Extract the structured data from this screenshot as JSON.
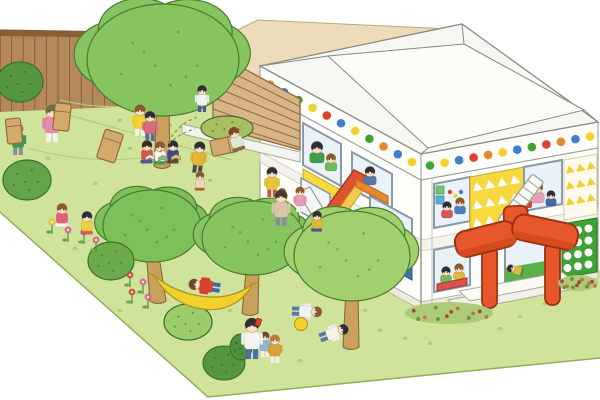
{
  "scene": {
    "subject": "Children playing in a kindergarten playground illustration",
    "elements": [
      "wooden plank fence",
      "grass yard",
      "two-story nursery building with polka-dot roof trim",
      "orange entrance canopy",
      "trees",
      "hammock",
      "sack race",
      "flower patches"
    ]
  },
  "colors": {
    "sky": "#ffffff",
    "grass": "#cfe39a",
    "grassEdge": "#93ad5c",
    "grassTuft": "#a4bf6a",
    "contour": "#b2cc7a",
    "fence": "#b5885c",
    "fenceLine": "#86603a",
    "fenceCap": "#8a5f38",
    "beige": "#ecdcba",
    "beigeLine": "#bba878",
    "louver": "#d9b487",
    "louverLine": "#8a6a42",
    "wall": "#fdfdf9",
    "wallLine": "#97978c",
    "roof": "#f6f6f2",
    "roofTop": "#fcfcf9",
    "plinth": "#ecebdd",
    "band": "#f3f3ec",
    "treeGreen": "#85c45e",
    "treeDark": "#4a7c30",
    "treeLight": "#a2d06e",
    "trunk": "#c9a05e",
    "trunkLine": "#8a6a3a",
    "orange": "#e8572b",
    "orangeDark": "#9c3312",
    "orangeShade": "#d64a20",
    "yellowPanel": "#f7d83e",
    "yellowDeep": "#f2cf2e",
    "yellowLine": "#c9a82a",
    "bluePanel": "#3f6fb5",
    "windowGlass": "#e8f2f8",
    "frame": "#8a9aa8",
    "greenWall": "#3fa235",
    "skin": "#f7dfc2",
    "skinLine": "#caa27b",
    "sack": "#d3a96c",
    "sackLine": "#8a6a3a",
    "hammock": "#f2d12e",
    "hammockLine": "#b09418",
    "ball": "#f2d12e",
    "ballLine": "#b89a1f",
    "bedBase": "#aac973",
    "bedDot1": "#9a4f3f",
    "bedDot2": "#c96a55",
    "bedDot3": "#6a8f3f",
    "deskOrange": "#e8872b",
    "tableRed": "#d9534f",
    "toyOrange": "#e8a13a",
    "eye": "#4a3a30"
  },
  "fence": {
    "planks": 19
  },
  "louver": {
    "slats": 6
  },
  "building": {
    "floors": 2,
    "fascia_dots_left": [
      "#e8872b",
      "#3f7fd1",
      "#3fa235",
      "#f2d12e",
      "#d9442e",
      "#3f7fd1",
      "#f2d12e",
      "#3fa235",
      "#e8872b",
      "#3f7fd1",
      "#f2d12e"
    ],
    "fascia_dots_right": [
      "#3fa235",
      "#f2d12e",
      "#3f7fd1",
      "#d9442e",
      "#e8872b",
      "#f2d12e",
      "#3f7fd1",
      "#3fa235",
      "#d9442e",
      "#e8872b",
      "#3f7fd1",
      "#f2d12e"
    ],
    "window_dots": [
      "#d9442e",
      "#f2d12e",
      "#3f7fd1"
    ],
    "panel_squares": [
      "#6fc96f",
      "#5ab0d0"
    ]
  },
  "trees": [
    {
      "name": "big-tree",
      "cx": 163,
      "cy": 60,
      "rx": 76,
      "ry": 56,
      "baseX": 162,
      "baseY": 166,
      "fill": "#85c45e"
    },
    {
      "name": "hammock-tree-left",
      "cx": 152,
      "cy": 226,
      "rx": 49,
      "ry": 36,
      "baseX": 158,
      "baseY": 301,
      "fill": "#7dbf58"
    },
    {
      "name": "hammock-tree-right",
      "cx": 253,
      "cy": 238,
      "rx": 51,
      "ry": 37,
      "baseX": 250,
      "baseY": 313,
      "fill": "#85c45e"
    },
    {
      "name": "front-tree",
      "cx": 352,
      "cy": 256,
      "rx": 58,
      "ry": 45,
      "baseX": 351,
      "baseY": 347,
      "fill": "#a2d06e"
    }
  ],
  "bushes": [
    {
      "cx": 20,
      "cy": 82,
      "rx": 23,
      "ry": 20,
      "fill": "#55973f"
    },
    {
      "cx": 227,
      "cy": 128,
      "rx": 26,
      "ry": 12,
      "fill": "#a8bf63"
    },
    {
      "cx": 27,
      "cy": 180,
      "rx": 24,
      "ry": 20,
      "fill": "#63a449"
    },
    {
      "cx": 111,
      "cy": 261,
      "rx": 23,
      "ry": 19,
      "fill": "#6cab4c"
    },
    {
      "cx": 188,
      "cy": 322,
      "rx": 24,
      "ry": 18,
      "fill": "#9ccb6a"
    },
    {
      "cx": 224,
      "cy": 363,
      "rx": 21,
      "ry": 17,
      "fill": "#55973f"
    },
    {
      "cx": 241,
      "cy": 347,
      "rx": 11,
      "ry": 13,
      "fill": "#4e8f3d"
    }
  ],
  "flower_clusters": [
    {
      "cx": 72,
      "cy": 232,
      "flowers": [
        {
          "dx": -20,
          "dy": -10,
          "c": "#f2d12e"
        },
        {
          "dx": -4,
          "dy": -2,
          "c": "#e86aa0"
        },
        {
          "dx": 12,
          "dy": 0,
          "c": "#9a5ab8"
        },
        {
          "dx": 24,
          "dy": 8,
          "c": "#e86aa0"
        }
      ]
    },
    {
      "cx": 138,
      "cy": 287,
      "flowers": [
        {
          "dx": -8,
          "dy": -12,
          "c": "#d9534f"
        },
        {
          "dx": 5,
          "dy": -5,
          "c": "#e86aa0"
        },
        {
          "dx": -6,
          "dy": 5,
          "c": "#d9534f"
        },
        {
          "dx": 10,
          "dy": 10,
          "c": "#e86aa0"
        }
      ]
    }
  ],
  "flower_beds": [
    {
      "cx": 449,
      "cy": 313,
      "rx": 44,
      "ry": 11
    },
    {
      "cx": 578,
      "cy": 283,
      "rx": 20,
      "ry": 8
    }
  ],
  "figures": [
    {
      "name": "standing-kid-top",
      "x": 202,
      "y": 112,
      "s": 0.85,
      "pose": "stand",
      "rot": 0,
      "hair": "#2e2e38",
      "shirt": "#eef2f5",
      "pants": "#4a5a8e",
      "layer": "yard"
    },
    {
      "name": "sack-kid-green",
      "x": 18,
      "y": 155,
      "s": 1,
      "pose": "stand",
      "rot": 0,
      "hair": "#b5854f",
      "shirt": "#3f9e4d",
      "pants": "#8a8f98",
      "layer": "yard"
    },
    {
      "name": "sack-teacher",
      "x": 52,
      "y": 142,
      "s": 1.2,
      "pose": "stand",
      "rot": 0,
      "hair": "#6b6f4a",
      "shirt": "#e88bb0",
      "pants": "#f2f2ee",
      "layer": "yard"
    },
    {
      "name": "cheer-girl",
      "x": 140,
      "y": 136,
      "s": 1,
      "pose": "stand",
      "rot": 0,
      "hair": "#8a5a2e",
      "shirt": "#f2d335",
      "pants": "#f6f3ea",
      "layer": "yard"
    },
    {
      "name": "reading-stand-kid",
      "x": 150,
      "y": 141,
      "s": 0.95,
      "pose": "stand",
      "rot": 0,
      "hair": "#2e2e38",
      "shirt": "#d86a7e",
      "pants": "#5a6b9e",
      "layer": "yard"
    },
    {
      "name": "fallen-sack-boy",
      "x": 240,
      "y": 151,
      "s": 1,
      "pose": "sit",
      "rot": -18,
      "hair": "#7a4a28",
      "shirt": "#dfe8d2",
      "pants": "#8a6a3f",
      "layer": "yard"
    },
    {
      "name": "reader-1",
      "x": 147,
      "y": 164,
      "s": 0.95,
      "pose": "sit",
      "rot": 0,
      "hair": "#3a2a20",
      "shirt": "#d95555",
      "pants": "#4a5a8e",
      "layer": "yard"
    },
    {
      "name": "reader-2",
      "x": 160,
      "y": 165,
      "s": 0.95,
      "pose": "sit",
      "rot": 0,
      "hair": "#8a5a2e",
      "shirt": "#f2f0e8",
      "pants": "#3f9e4d",
      "layer": "yard"
    },
    {
      "name": "reader-3",
      "x": 173,
      "y": 164,
      "s": 0.95,
      "pose": "sit",
      "rot": 0,
      "hair": "#2e2e38",
      "shirt": "#3b4a8c",
      "pants": "#6a4a2e",
      "layer": "yard"
    },
    {
      "name": "chase-girl",
      "x": 197,
      "y": 173,
      "s": 1,
      "pose": "stand",
      "rot": 6,
      "hair": "#2e2e38",
      "shirt": "#e0b73a",
      "pants": "#4a4a52",
      "layer": "yard"
    },
    {
      "name": "chase-toddler",
      "x": 200,
      "y": 191,
      "s": 0.78,
      "pose": "crouch",
      "rot": 0,
      "hair": "#8a5a2e",
      "shirt": "#e8d9b8",
      "pants": "#a66a32",
      "layer": "yard"
    },
    {
      "name": "walk-girl",
      "x": 272,
      "y": 197,
      "s": 0.95,
      "pose": "stand",
      "rot": 0,
      "hair": "#2e2e38",
      "shirt": "#e8c63a",
      "pants": "#c9573f",
      "layer": "yard"
    },
    {
      "name": "walk-toddler",
      "x": 282,
      "y": 207,
      "s": 0.75,
      "pose": "crouch",
      "rot": 0,
      "hair": "#6a4a2e",
      "shirt": "#d9a33c",
      "pants": "#8a6a3f",
      "layer": "yard"
    },
    {
      "name": "flower-girl",
      "x": 62,
      "y": 227,
      "s": 0.95,
      "pose": "crouch",
      "rot": 0,
      "hair": "#8a5a2e",
      "shirt": "#e2607a",
      "pants": "#f2f2ee",
      "layer": "yard"
    },
    {
      "name": "flower-boy",
      "x": 87,
      "y": 235,
      "s": 0.95,
      "pose": "crouch",
      "rot": 0,
      "hair": "#2e2e38",
      "shirt": "#efcf3a",
      "pants": "#d95555",
      "layer": "yard"
    },
    {
      "name": "hammock-kid",
      "x": 220,
      "y": 288,
      "s": 1,
      "pose": "stand",
      "rot": -82,
      "hair": "#6a4a2e",
      "shirt": "#d9442e",
      "pants": "#4466aa",
      "layer": "yard"
    },
    {
      "name": "slide-teacher",
      "x": 281,
      "y": 226,
      "s": 1.15,
      "pose": "stand",
      "rot": 0,
      "hair": "#4a3a2e",
      "shirt": "#d9c6a8",
      "pants": "#8a8f98",
      "layer": "yard"
    },
    {
      "name": "slide-kid-pink",
      "x": 300,
      "y": 212,
      "s": 0.8,
      "pose": "stand",
      "rot": 0,
      "hair": "#8a5a2e",
      "shirt": "#e89bb5",
      "pants": "#f2f2ee",
      "layer": "yard"
    },
    {
      "name": "slide-kid-mustard",
      "x": 317,
      "y": 232,
      "s": 0.85,
      "pose": "sit",
      "rot": 0,
      "hair": "#2e2e38",
      "shirt": "#e0b73a",
      "pants": "#4a5a8e",
      "layer": "yard"
    },
    {
      "name": "dad-drinking",
      "x": 252,
      "y": 359,
      "s": 1.3,
      "pose": "stand",
      "rot": 0,
      "hair": "#2e2e38",
      "shirt": "#f5f3ee",
      "pants": "#4a6fa5",
      "layer": "yard"
    },
    {
      "name": "drink-kid-blue",
      "x": 265,
      "y": 357,
      "s": 0.8,
      "pose": "stand",
      "rot": 0,
      "hair": "#6a4a2e",
      "shirt": "#8ab8d8",
      "pants": "#f2f2ee",
      "layer": "yard"
    },
    {
      "name": "drink-kid-mustard",
      "x": 275,
      "y": 363,
      "s": 0.9,
      "pose": "stand",
      "rot": 0,
      "hair": "#c07a3a",
      "shirt": "#d9a33c",
      "pants": "#f2f2ee",
      "layer": "yard"
    },
    {
      "name": "lying-kid-1",
      "x": 292,
      "y": 311,
      "s": 0.95,
      "pose": "stand",
      "rot": 92,
      "hair": "#8a5a2e",
      "shirt": "#eef2f5",
      "pants": "#5577aa",
      "layer": "yard"
    },
    {
      "name": "lying-kid-2",
      "x": 320,
      "y": 338,
      "s": 0.95,
      "pose": "stand",
      "rot": 70,
      "hair": "#2e2e38",
      "shirt": "#f5f3ee",
      "pants": "#5577aa",
      "layer": "yard"
    },
    {
      "name": "win-left-teacher",
      "x": 317,
      "y": 163,
      "s": 1.05,
      "pose": "bust",
      "rot": 0,
      "hair": "#2e2e38",
      "shirt": "#3f9e4d",
      "layer": "window"
    },
    {
      "name": "win-left-boy",
      "x": 331,
      "y": 171,
      "s": 0.85,
      "pose": "bust",
      "rot": 0,
      "hair": "#8a5a2e",
      "shirt": "#6fba5c",
      "layer": "window"
    },
    {
      "name": "win-desk-boy",
      "x": 370,
      "y": 185,
      "s": 0.9,
      "pose": "bust",
      "rot": 0,
      "hair": "#2e2e38",
      "shirt": "#5577aa",
      "layer": "window"
    },
    {
      "name": "win-a-kid-1",
      "x": 447,
      "y": 218,
      "s": 0.8,
      "pose": "bust",
      "rot": 0,
      "hair": "#2e2e38",
      "shirt": "#d95555",
      "layer": "window"
    },
    {
      "name": "win-a-kid-2",
      "x": 460,
      "y": 214,
      "s": 0.8,
      "pose": "bust",
      "rot": 0,
      "hair": "#8a5a2e",
      "shirt": "#4a7fc1",
      "layer": "window"
    },
    {
      "name": "win-b-teacher",
      "x": 537,
      "y": 203,
      "s": 1.05,
      "pose": "bust",
      "rot": 0,
      "hair": "#8a4a2a",
      "shirt": "#e8a0b8",
      "layer": "window"
    },
    {
      "name": "win-b-kid-1",
      "x": 551,
      "y": 206,
      "s": 0.75,
      "pose": "bust",
      "rot": 0,
      "hair": "#2e2e38",
      "shirt": "#4466aa",
      "layer": "window"
    },
    {
      "name": "win-b-kid-2",
      "x": 527,
      "y": 208,
      "s": 0.7,
      "pose": "bust",
      "rot": 0,
      "hair": "#6a4a2e",
      "shirt": "#d9442e",
      "layer": "window"
    },
    {
      "name": "win-c-kid-1",
      "x": 446,
      "y": 283,
      "s": 0.8,
      "pose": "bust",
      "rot": 0,
      "hair": "#2e2e38",
      "shirt": "#6fba5c",
      "layer": "window"
    },
    {
      "name": "win-c-kid-2",
      "x": 459,
      "y": 280,
      "s": 0.8,
      "pose": "bust",
      "rot": 0,
      "hair": "#8a5a2e",
      "shirt": "#e0b73a",
      "layer": "window"
    },
    {
      "name": "win-d-reader",
      "x": 524,
      "y": 272,
      "s": 0.7,
      "pose": "sit",
      "rot": -75,
      "hair": "#2e2e38",
      "shirt": "#e0b73a",
      "pants": "#3f9e4d",
      "layer": "window"
    }
  ],
  "props": {
    "sacks": [
      {
        "x": 14,
        "y": 131,
        "rot": -6,
        "w": 15,
        "h": 25,
        "layer": "front"
      },
      {
        "x": 62,
        "y": 117,
        "rot": 6,
        "w": 16,
        "h": 27,
        "layer": "front"
      },
      {
        "x": 110,
        "y": 146,
        "rot": 18,
        "w": 19,
        "h": 30,
        "layer": "front"
      },
      {
        "x": 224,
        "y": 146,
        "rot": 78,
        "w": 16,
        "h": 26,
        "layer": "back"
      }
    ],
    "books": [
      {
        "x": 150,
        "y": 157,
        "c": "#f5f5f0"
      },
      {
        "x": 163,
        "y": 158,
        "c": "#7fc97f"
      },
      {
        "x": 176,
        "y": 157,
        "c": "#f2d12e"
      }
    ],
    "ball": {
      "x": 301,
      "y": 324,
      "r": 6.5
    },
    "hammock": {
      "x1": 155,
      "y1": 276,
      "x2": 252,
      "y2": 284,
      "sag": 22
    },
    "cup": {
      "x": 257,
      "y": 318
    }
  }
}
